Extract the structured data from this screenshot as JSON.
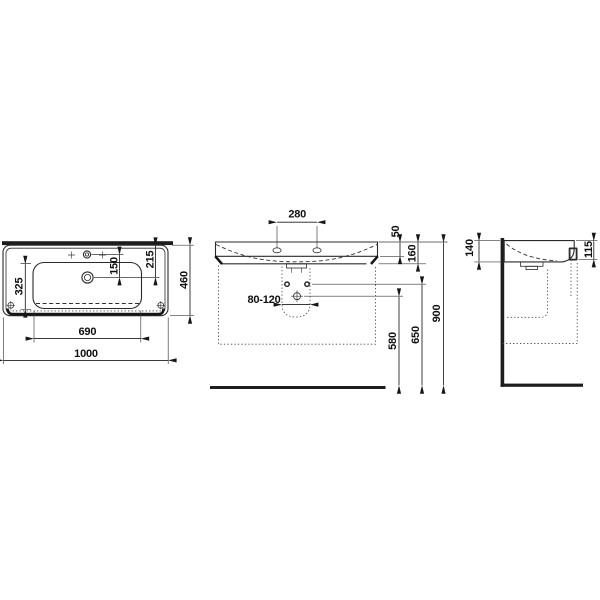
{
  "drawing": {
    "type": "washbasin-dimension-drawing",
    "colors": {
      "background": "#ffffff",
      "line": "#2b2b2b",
      "section_fill": "#1d1d1d"
    }
  },
  "dims": {
    "overall_width": "1000",
    "bowl_width": "690",
    "overall_depth": "460",
    "bowl_depth": "325",
    "tap_to_drain": "150",
    "rear_to_drain": "215",
    "tap_spacing": "280",
    "rim_drop": "50",
    "basin_front_height": "160",
    "drain_range": "80-120",
    "outlet_height": "580",
    "bolt_height": "650",
    "rim_height": "900",
    "wall_side_height": "140",
    "front_edge_height": "115"
  }
}
